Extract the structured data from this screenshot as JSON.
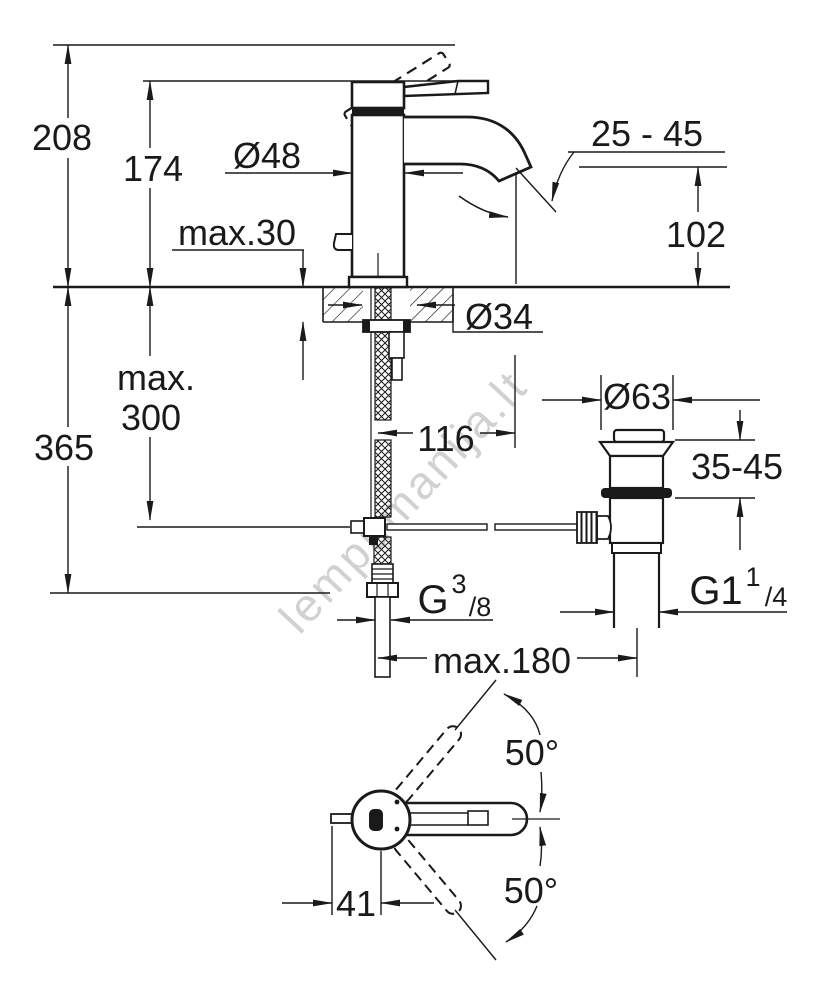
{
  "drawing": {
    "watermark": "lempumanija.lt",
    "front_view": {
      "overall_height": "208",
      "body_height": "174",
      "body_diameter": "Ø48",
      "deck_thickness": "max.30",
      "aerator_range": "25 - 45",
      "spout_height": "102",
      "hole_diameter": "Ø34",
      "hose_limit_line1": "max.",
      "hose_limit_line2": "300",
      "overall_depth": "365",
      "spout_reach": "116"
    },
    "drain": {
      "flange_diameter": "Ø63",
      "mount_range": "35-45",
      "thread_base": "G1",
      "thread_sup": "1",
      "thread_sub": "/4"
    },
    "supply": {
      "thread_base": "G",
      "thread_sup": "3",
      "thread_sub": "/8",
      "reach_limit": "max.180"
    },
    "top_view": {
      "swivel_upper": "50°",
      "swivel_lower": "50°",
      "handle_offset": "41"
    }
  }
}
